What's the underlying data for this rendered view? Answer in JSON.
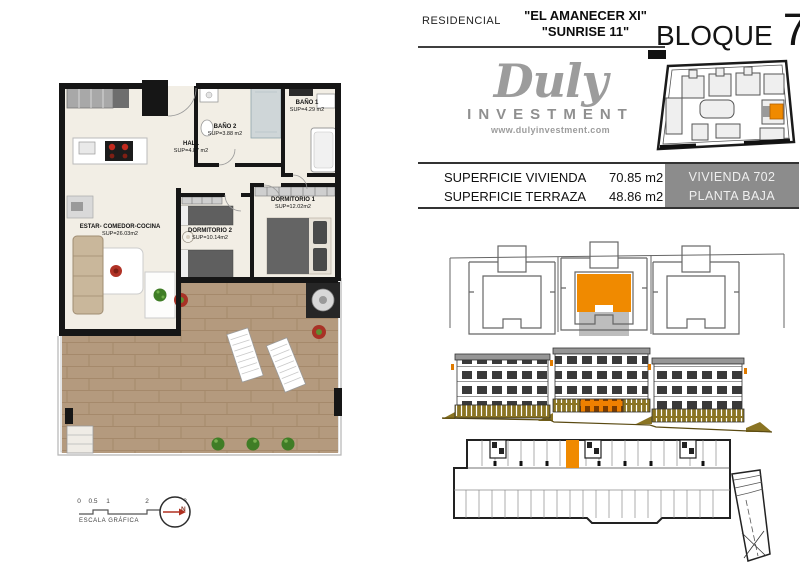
{
  "header": {
    "residencial_label": "RESIDENCIAL",
    "project_name_line1": "\"EL AMANECER XI\"",
    "project_name_line2": "\"SUNRISE 11\"",
    "bloque_label": "BLOQUE",
    "bloque_number": "7"
  },
  "logo": {
    "brand": "Duly",
    "subtitle": "INVESTMENT",
    "website": "www.dulyinvestment.com"
  },
  "summary": {
    "rows": [
      {
        "label": "SUPERFICIE VIVIENDA",
        "value": "70.85 m2"
      },
      {
        "label": "SUPERFICIE TERRAZA",
        "value": "48.86 m2"
      }
    ],
    "unit": {
      "line1": "VIVIENDA 702",
      "line2": "PLANTA BAJA"
    }
  },
  "floorplan": {
    "rooms": [
      {
        "name": "BAÑO 2",
        "area": "SUP=3.88 m2"
      },
      {
        "name": "BAÑO 1",
        "area": "SUP=4.29 m2"
      },
      {
        "name": "HALL",
        "area": "SUP=4.87 m2"
      },
      {
        "name": "DORMITORIO 1",
        "area": "SUP=12.02m2"
      },
      {
        "name": "DORMITORIO 2",
        "area": "SUP=10.14m2"
      },
      {
        "name": "ESTAR- COMEDOR-COCINA",
        "area": "SUP=26.03m2"
      }
    ],
    "scale": {
      "ticks": [
        "0",
        "0.5",
        "1",
        "2",
        "3"
      ],
      "label": "ESCALA GRÁFICA"
    },
    "compass": {
      "label": "N"
    }
  },
  "colors": {
    "accent_orange": "#F08A00",
    "olive_base": "#8A7423",
    "wall_black": "#161616",
    "wood_terrace": "#B49A7E",
    "floor_cream": "#F2EEE5",
    "unit_box_gray": "#8C8C8C",
    "logo_gray": "#9C9C9C",
    "red_accent": "#B03226"
  }
}
